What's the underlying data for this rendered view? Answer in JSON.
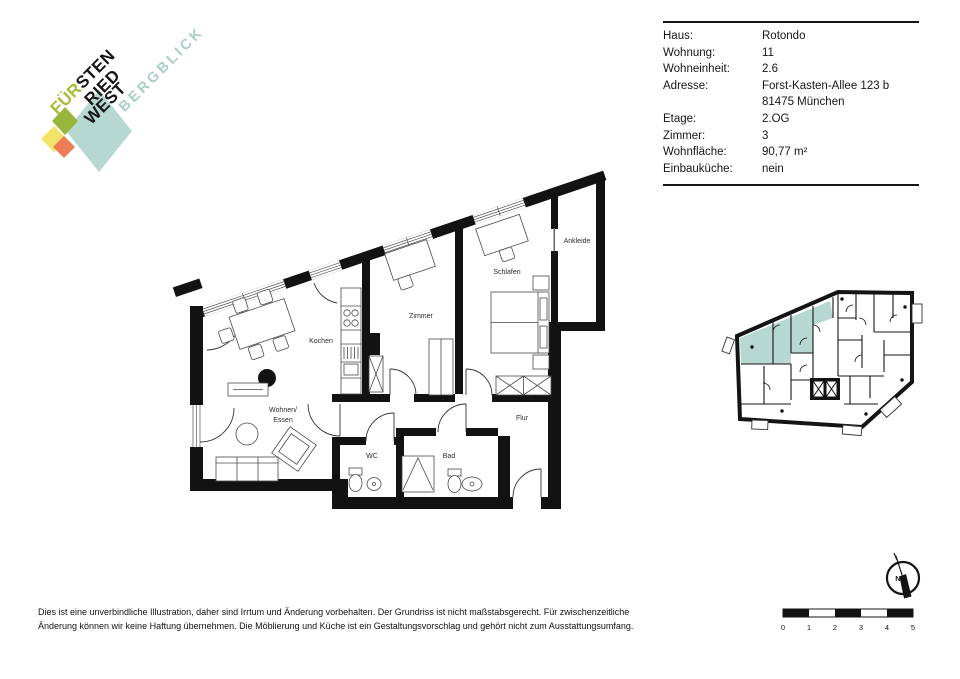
{
  "logo": {
    "line1_accent": "FÜR",
    "line1_rest": "STEN",
    "line2": "RIED",
    "line3": "WEST",
    "subtitle": "BERGBLICK",
    "colors": {
      "accent_lime": "#a5bd35",
      "subtitle_teal": "#a9cfc7",
      "diamond_teal": "#b7d8d1",
      "diamond_olive": "#97b63c",
      "diamond_yellow": "#f2e468",
      "diamond_orange": "#ec7d55"
    }
  },
  "info_panel": {
    "rows": [
      {
        "label": "Haus:",
        "value": "Rotondo"
      },
      {
        "label": "Wohnung:",
        "value": "11"
      },
      {
        "label": "Wohneinheit:",
        "value": "2.6"
      },
      {
        "label": "Adresse:",
        "value": "Forst-Kasten-Allee 123 b"
      },
      {
        "label": "",
        "value": "81475 München"
      },
      {
        "label": "Etage:",
        "value": "2.OG"
      },
      {
        "label": "Zimmer:",
        "value": "3"
      },
      {
        "label": "Wohnfläche:",
        "value": "90,77 m²"
      },
      {
        "label": "Einbauküche:",
        "value": "nein"
      }
    ]
  },
  "floor_plan": {
    "rooms": {
      "kochen": "Kochen",
      "wohnen_line1": "Wohnen/",
      "wohnen_line2": "Essen",
      "zimmer": "Zimmer",
      "schlafen": "Schlafen",
      "ankleide": "Ankleide",
      "flur": "Flur",
      "wc": "WC",
      "bad": "Bad"
    },
    "wall_color": "#121212"
  },
  "overview_plan": {
    "highlight_color": "#b7d8d1"
  },
  "compass": {
    "north_label": "N"
  },
  "scale_bar": {
    "labels": [
      "0",
      "1",
      "2",
      "3",
      "4",
      "5"
    ]
  },
  "disclaimer": {
    "line1": "Dies ist eine unverbindliche Illustration, daher sind Irrtum und Änderung vorbehalten. Der Grundriss ist nicht maßstabsgerecht. Für zwischenzeitliche",
    "line2": "Änderung können wir keine Haftung übernehmen. Die Möblierung und Küche ist ein Gestaltungsvorschlag und gehört nicht zum Ausstattungsumfang."
  }
}
